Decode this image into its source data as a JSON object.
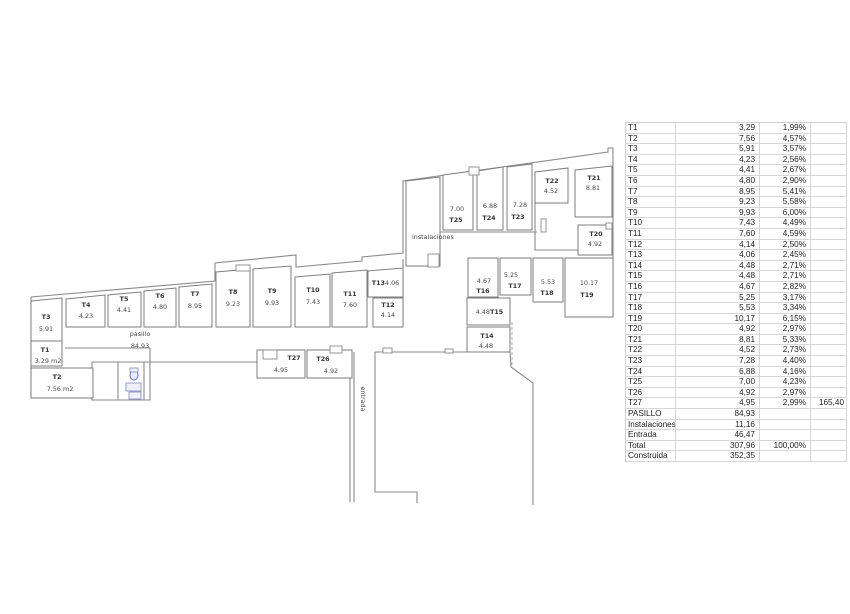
{
  "table": {
    "rows": [
      {
        "label": "T1",
        "value": "3,29",
        "pct": "1,99%",
        "extra": ""
      },
      {
        "label": "T2",
        "value": "7,56",
        "pct": "4,57%",
        "extra": ""
      },
      {
        "label": "T3",
        "value": "5,91",
        "pct": "3,57%",
        "extra": ""
      },
      {
        "label": "T4",
        "value": "4,23",
        "pct": "2,56%",
        "extra": ""
      },
      {
        "label": "T5",
        "value": "4,41",
        "pct": "2,67%",
        "extra": ""
      },
      {
        "label": "T6",
        "value": "4,80",
        "pct": "2,90%",
        "extra": ""
      },
      {
        "label": "T7",
        "value": "8,95",
        "pct": "5,41%",
        "extra": ""
      },
      {
        "label": "T8",
        "value": "9,23",
        "pct": "5,58%",
        "extra": ""
      },
      {
        "label": "T9",
        "value": "9,93",
        "pct": "6,00%",
        "extra": ""
      },
      {
        "label": "T10",
        "value": "7,43",
        "pct": "4,49%",
        "extra": ""
      },
      {
        "label": "T11",
        "value": "7,60",
        "pct": "4,59%",
        "extra": ""
      },
      {
        "label": "T12",
        "value": "4,14",
        "pct": "2,50%",
        "extra": ""
      },
      {
        "label": "T13",
        "value": "4,06",
        "pct": "2,45%",
        "extra": ""
      },
      {
        "label": "T14",
        "value": "4,48",
        "pct": "2,71%",
        "extra": ""
      },
      {
        "label": "T15",
        "value": "4,48",
        "pct": "2,71%",
        "extra": ""
      },
      {
        "label": "T16",
        "value": "4,67",
        "pct": "2,82%",
        "extra": ""
      },
      {
        "label": "T17",
        "value": "5,25",
        "pct": "3,17%",
        "extra": ""
      },
      {
        "label": "T18",
        "value": "5,53",
        "pct": "3,34%",
        "extra": ""
      },
      {
        "label": "T19",
        "value": "10,17",
        "pct": "6,15%",
        "extra": ""
      },
      {
        "label": "T20",
        "value": "4,92",
        "pct": "2,97%",
        "extra": ""
      },
      {
        "label": "T21",
        "value": "8,81",
        "pct": "5,33%",
        "extra": ""
      },
      {
        "label": "T22",
        "value": "4,52",
        "pct": "2,73%",
        "extra": ""
      },
      {
        "label": "T23",
        "value": "7,28",
        "pct": "4,40%",
        "extra": ""
      },
      {
        "label": "T24",
        "value": "6,88",
        "pct": "4,16%",
        "extra": ""
      },
      {
        "label": "T25",
        "value": "7,00",
        "pct": "4,23%",
        "extra": ""
      },
      {
        "label": "T26",
        "value": "4,92",
        "pct": "2,97%",
        "extra": ""
      },
      {
        "label": "T27",
        "value": "4,95",
        "pct": "2,99%",
        "extra": "165,40"
      },
      {
        "label": "PASILLO",
        "value": "84,93",
        "pct": "",
        "extra": ""
      },
      {
        "label": "Instalaciones",
        "value": "11,16",
        "pct": "",
        "extra": ""
      },
      {
        "label": "Entrada",
        "value": "46,47",
        "pct": "",
        "extra": ""
      },
      {
        "label": "Total",
        "value": "307,96",
        "pct": "100,00%",
        "extra": ""
      },
      {
        "label": "Construida",
        "value": "352,35",
        "pct": "",
        "extra": ""
      }
    ]
  },
  "plan": {
    "colors": {
      "wall": "#8a8a8a",
      "room_stroke": "#7e7e7e",
      "text": "#4a4a4a",
      "fixture": "#6f74c9"
    },
    "texts": [
      {
        "t": "pasillo",
        "x": 140,
        "y": 336,
        "name": "pasillo-label"
      },
      {
        "t": "84.93",
        "x": 140,
        "y": 348,
        "name": "pasillo-area"
      },
      {
        "t": "instalaciones",
        "x": 412,
        "y": 239,
        "a": "start",
        "name": "instalaciones-label"
      },
      {
        "t": "entrada",
        "x": 361,
        "y": 399,
        "rot": 90,
        "name": "entrada-label"
      }
    ],
    "rooms": [
      {
        "id": "T3",
        "poly": "31,301 62,298 62,341 31,341",
        "labels": [
          {
            "t": "T3",
            "x": 46,
            "y": 319,
            "b": 1
          },
          {
            "t": "5.91",
            "x": 46,
            "y": 331
          }
        ]
      },
      {
        "id": "T1",
        "poly": "31,341 62,341 62,366 31,366",
        "labels": [
          {
            "t": "T1",
            "x": 45,
            "y": 352,
            "b": 1
          },
          {
            "t": "3.29 m2",
            "x": 48,
            "y": 363
          }
        ]
      },
      {
        "id": "T2",
        "poly": "31,368 93,368 93,398 31,398",
        "labels": [
          {
            "t": "T2",
            "x": 57,
            "y": 379,
            "b": 1
          },
          {
            "t": "7.56 m2",
            "x": 60,
            "y": 391
          }
        ]
      },
      {
        "id": "T4",
        "poly": "66,299 105,295 105,327 66,327",
        "labels": [
          {
            "t": "T4",
            "x": 86,
            "y": 307,
            "b": 1
          },
          {
            "t": "4.23",
            "x": 86,
            "y": 318
          }
        ]
      },
      {
        "id": "T5",
        "poly": "108,295 141,292 141,327 108,327",
        "labels": [
          {
            "t": "T5",
            "x": 124,
            "y": 301,
            "b": 1
          },
          {
            "t": "4.41",
            "x": 124,
            "y": 312
          }
        ]
      },
      {
        "id": "T6",
        "poly": "144,291 176,288 176,327 144,327",
        "labels": [
          {
            "t": "T6",
            "x": 160,
            "y": 298,
            "b": 1
          },
          {
            "t": "4.80",
            "x": 160,
            "y": 309
          }
        ]
      },
      {
        "id": "T7",
        "poly": "179,287 212,284 212,327 179,327",
        "labels": [
          {
            "t": "T7",
            "x": 195,
            "y": 296,
            "b": 1
          },
          {
            "t": "8.95",
            "x": 195,
            "y": 308
          }
        ]
      },
      {
        "id": "T8",
        "poly": "216,272 250,269 250,327 216,327",
        "labels": [
          {
            "t": "T8",
            "x": 233,
            "y": 294,
            "b": 1
          },
          {
            "t": "9.23",
            "x": 233,
            "y": 306
          }
        ]
      },
      {
        "id": "T9",
        "poly": "253,269 291,266 291,327 253,327",
        "labels": [
          {
            "t": "T9",
            "x": 272,
            "y": 293,
            "b": 1
          },
          {
            "t": "9.93",
            "x": 272,
            "y": 305
          }
        ]
      },
      {
        "id": "T10",
        "poly": "295,277 330,274 330,327 295,327",
        "labels": [
          {
            "t": "T10",
            "x": 313,
            "y": 292,
            "b": 1
          },
          {
            "t": "7.43",
            "x": 313,
            "y": 304
          }
        ]
      },
      {
        "id": "T11",
        "poly": "332,273 367,270 367,327 332,327",
        "labels": [
          {
            "t": "T11",
            "x": 350,
            "y": 296,
            "b": 1
          },
          {
            "t": "7.60",
            "x": 350,
            "y": 307
          }
        ]
      },
      {
        "id": "T13",
        "poly": "368,271 403,268 403,297 368,297",
        "labels": [
          {
            "t": "T13",
            "x": 385,
            "y": 285,
            "b": 1,
            "a": "end"
          },
          {
            "t": "4.06",
            "x": 385,
            "y": 285,
            "a": "start"
          }
        ]
      },
      {
        "id": "T12",
        "poly": "373,298 403,298 403,327 373,327",
        "labels": [
          {
            "t": "T12",
            "x": 388,
            "y": 307,
            "b": 1
          },
          {
            "t": "4.14",
            "x": 388,
            "y": 317
          }
        ]
      },
      {
        "id": "INST",
        "poly": "406,181 440,177 440,266 406,266",
        "labels": []
      },
      {
        "id": "T25",
        "poly": "443,175 473,171 473,230 443,230",
        "labels": [
          {
            "t": "7.00",
            "x": 457,
            "y": 211
          },
          {
            "t": "T25",
            "x": 456,
            "y": 222,
            "b": 1
          }
        ]
      },
      {
        "id": "T24",
        "poly": "477,171 503,167 503,230 477,230",
        "labels": [
          {
            "t": "6.88",
            "x": 490,
            "y": 208
          },
          {
            "t": "T24",
            "x": 489,
            "y": 220,
            "b": 1
          }
        ]
      },
      {
        "id": "T23",
        "poly": "507,167 532,164 532,230 507,230",
        "labels": [
          {
            "t": "7.28",
            "x": 520,
            "y": 207
          },
          {
            "t": "T23",
            "x": 518,
            "y": 219,
            "b": 1
          }
        ]
      },
      {
        "id": "T22",
        "poly": "535,172 568,168 568,203 535,203",
        "labels": [
          {
            "t": "T22",
            "x": 552,
            "y": 183,
            "b": 1
          },
          {
            "t": "4.52",
            "x": 551,
            "y": 193
          }
        ]
      },
      {
        "id": "T21",
        "poly": "575,170 612,166 612,217 575,217",
        "labels": [
          {
            "t": "T21",
            "x": 594,
            "y": 180,
            "b": 1
          },
          {
            "t": "8.81",
            "x": 593,
            "y": 190
          }
        ]
      },
      {
        "id": "T20",
        "poly": "578,225 612,225 612,255 578,255",
        "labels": [
          {
            "t": "T20",
            "x": 596,
            "y": 236,
            "b": 1
          },
          {
            "t": "4.92",
            "x": 595,
            "y": 246
          }
        ]
      },
      {
        "id": "T16",
        "poly": "468,258 498,258 498,297 468,297",
        "labels": [
          {
            "t": "4.67",
            "x": 484,
            "y": 283
          },
          {
            "t": "T16",
            "x": 483,
            "y": 293,
            "b": 1
          }
        ]
      },
      {
        "id": "T17",
        "poly": "500,258 531,258 531,295 500,295",
        "labels": [
          {
            "t": "5.25",
            "x": 511,
            "y": 277
          },
          {
            "t": "T17",
            "x": 515,
            "y": 288,
            "b": 1
          }
        ]
      },
      {
        "id": "T18",
        "poly": "533,258 563,258 563,302 533,302",
        "labels": [
          {
            "t": "5.53",
            "x": 548,
            "y": 284
          },
          {
            "t": "T18",
            "x": 547,
            "y": 295,
            "b": 1
          }
        ]
      },
      {
        "id": "T19",
        "poly": "565,258 613,258 613,317 565,317",
        "labels": [
          {
            "t": "10.17",
            "x": 589,
            "y": 285
          },
          {
            "t": "T19",
            "x": 587,
            "y": 297,
            "b": 1
          }
        ]
      },
      {
        "id": "T15",
        "poly": "467,298 510,298 510,325 467,325",
        "labels": [
          {
            "t": "4.48",
            "x": 490,
            "y": 314,
            "a": "end"
          },
          {
            "t": "T15",
            "x": 490,
            "y": 314,
            "a": "start",
            "b": 1
          }
        ]
      },
      {
        "id": "T14",
        "poly": "467,327 510,327 510,352 467,352",
        "labels": [
          {
            "t": "T14",
            "x": 487,
            "y": 338,
            "b": 1
          },
          {
            "t": "4.48",
            "x": 486,
            "y": 348
          }
        ]
      },
      {
        "id": "T27",
        "poly": "257,350 305,350 305,378 257,378",
        "labels": [
          {
            "t": "T27",
            "x": 294,
            "y": 360,
            "b": 1
          },
          {
            "t": "4.95",
            "x": 281,
            "y": 372
          }
        ]
      },
      {
        "id": "T26",
        "poly": "307,350 352,350 352,378 307,378",
        "labels": [
          {
            "t": "T26",
            "x": 323,
            "y": 361,
            "b": 1
          },
          {
            "t": "4.92",
            "x": 331,
            "y": 373
          }
        ]
      }
    ],
    "walls": [
      "M31,297 L215,281 L215,263 L296,255 L296,267 L362,261 L362,257 L403,253 L403,181 L608,152 L608,148 L613,148 L613,317 L567,317",
      "M403,259 L403,327",
      "M31,297 L31,398 L93,398",
      "M65,348 L150,348 L150,362 L257,362",
      "M92,362 L150,362 L150,400 L92,400 L92,362",
      "M118,362 L118,400",
      "M144,362 L144,400",
      "M350,350 L350,502",
      "M354,352 L354,502",
      "M375,352 L375,492 L417,492 L417,503",
      "M375,352 L467,352",
      "M510,352 L511,367 L533,383 L533,505",
      "M440,232 L537,232",
      "M535,203 L535,250 L578,250"
    ],
    "tabs": [
      [
        236,
        265,
        14,
        6
      ],
      [
        469,
        167,
        10,
        8
      ],
      [
        263,
        350,
        14,
        9
      ],
      [
        330,
        346,
        12,
        7
      ],
      [
        383,
        348,
        9,
        5
      ],
      [
        445,
        349,
        8,
        4
      ],
      [
        428,
        254,
        11,
        13
      ],
      [
        541,
        219,
        5,
        13
      ],
      [
        606,
        223,
        6,
        6
      ]
    ],
    "dashes": [
      "M512,322 L512,367"
    ],
    "fixtures": {
      "ellipse": {
        "cx": 134,
        "cy": 375,
        "rx": 4,
        "ry": 5
      },
      "rects": [
        [
          130,
          368,
          8,
          4
        ],
        [
          126,
          383,
          15,
          8
        ],
        [
          129,
          392,
          12,
          7
        ]
      ]
    }
  }
}
